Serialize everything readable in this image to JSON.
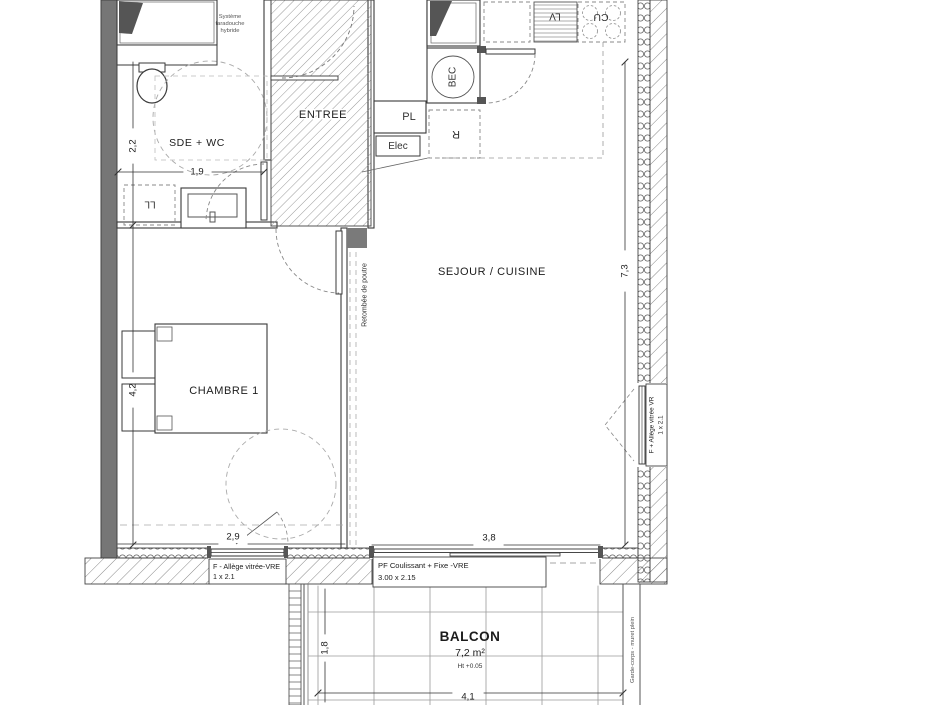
{
  "rooms": {
    "bathroom": "SDE + WC",
    "entry": "ENTREE",
    "living": "SEJOUR / CUISINE",
    "bedroom": "CHAMBRE 1",
    "balcony": "BALCON"
  },
  "balcony": {
    "area": "7,2 m²",
    "height_note": "Ht +0.05",
    "railing_note": "Garde-corps - muret plein"
  },
  "dimensions": {
    "bathroom_width": "2,2",
    "bathroom_depth": "1,9",
    "bedroom_length": "4,2",
    "bedroom_width": "2,9",
    "living_bay": "3,8",
    "facade_length": "7,3",
    "balcony_depth": "1,8",
    "balcony_length": "4,1"
  },
  "kitchen": {
    "dishwasher": "LV",
    "cooktop": "CU",
    "sink_unit": "BEC",
    "fridge": "R"
  },
  "fixtures": {
    "washing_machine": "LL",
    "closet": "PL",
    "electrical_panel": "Elec"
  },
  "annotations": {
    "heater_line1": "Système",
    "heater_line2": "taradouche",
    "heater_line3": "hybride",
    "beam": "Retombée de poutre"
  },
  "windows": {
    "bedroom_type": "F - Allège vitrée-VRE",
    "bedroom_size": "1 x 2.1",
    "living_type": "PF Coulissant + Fixe -VRE",
    "living_size": "3.00 x 2.15",
    "side_type": "F + Allège vitrée VR",
    "side_size": "1 x 2.1"
  }
}
